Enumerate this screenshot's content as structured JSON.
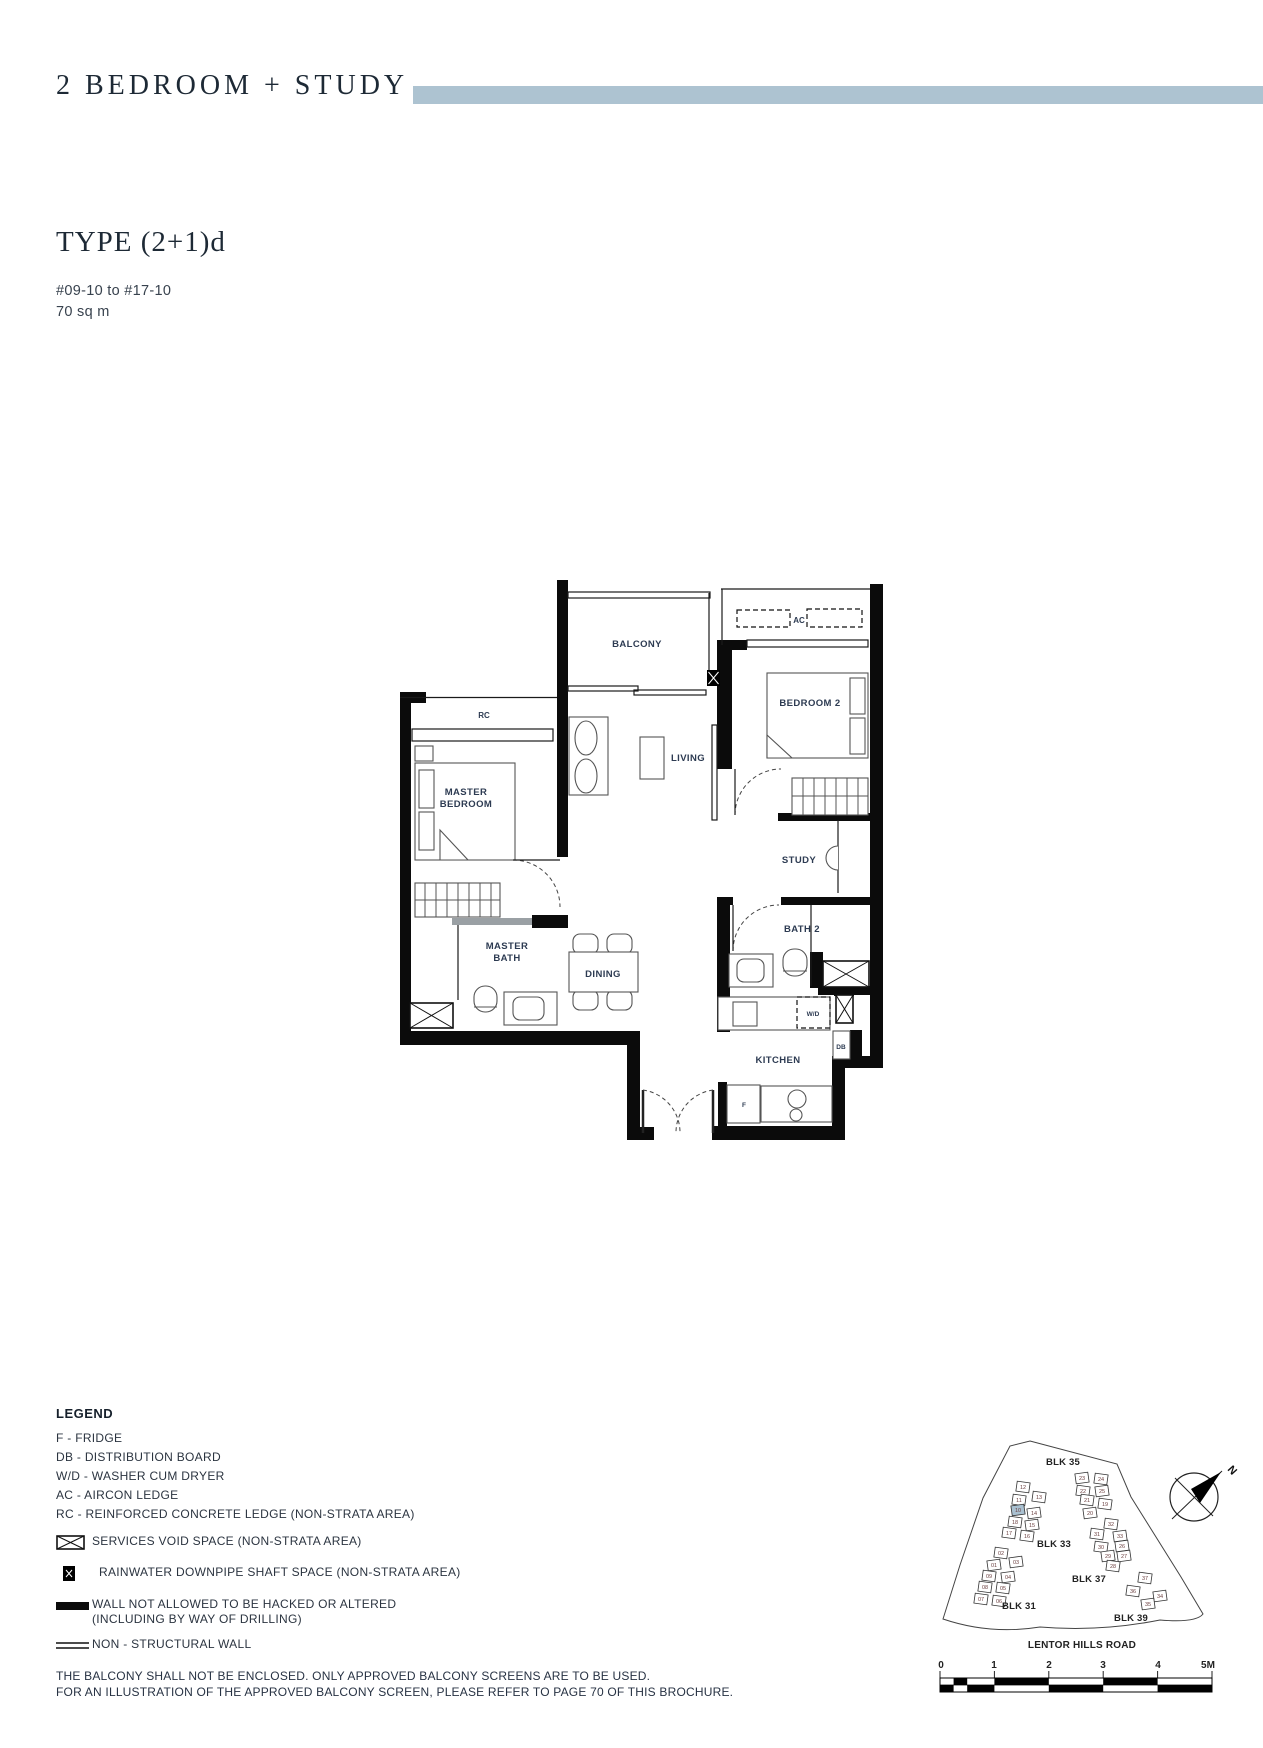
{
  "page": {
    "title": "2 BEDROOM + STUDY",
    "type_title": "TYPE (2+1)d",
    "units_range": "#09-10 to #17-10",
    "area": "70 sq m",
    "accent_color": "#adc3d1"
  },
  "plan": {
    "labels": {
      "balcony": "BALCONY",
      "rc": "RC",
      "ac": "AC",
      "master_bedroom_1": "MASTER",
      "master_bedroom_2": "BEDROOM",
      "living": "LIVING",
      "bedroom2": "BEDROOM 2",
      "study": "STUDY",
      "master_bath_1": "MASTER",
      "master_bath_2": "BATH",
      "dining": "DINING",
      "bath2": "BATH 2",
      "kitchen": "KITCHEN",
      "wd": "W/D",
      "db": "DB",
      "f": "F"
    }
  },
  "legend": {
    "heading": "LEGEND",
    "abbreviations": [
      "F - FRIDGE",
      "DB - DISTRIBUTION BOARD",
      "W/D - WASHER CUM DRYER",
      "AC - AIRCON LEDGE",
      "RC - REINFORCED CONCRETE LEDGE (NON-STRATA AREA)"
    ],
    "symbols": [
      {
        "icon": "services-void-icon",
        "label": "SERVICES VOID SPACE (NON-STRATA AREA)"
      },
      {
        "icon": "rainwater-shaft-icon",
        "label": "RAINWATER DOWNPIPE SHAFT SPACE (NON-STRATA AREA)"
      },
      {
        "icon": "no-hack-wall-icon",
        "label": "WALL NOT ALLOWED TO BE HACKED OR ALTERED",
        "label2": "(INCLUDING BY WAY OF DRILLING)"
      },
      {
        "icon": "non-structural-wall-icon",
        "label": "NON - STRUCTURAL WALL"
      }
    ]
  },
  "site_plan": {
    "blocks": [
      "BLK 35",
      "BLK 33",
      "BLK 31",
      "BLK 37",
      "BLK 39"
    ],
    "road": "LENTOR HILLS ROAD",
    "compass_label": "N",
    "highlight_unit": "10",
    "highlight_color": "#a9c0d0",
    "units": [
      [
        "12",
        1023,
        1487,
        0
      ],
      [
        "11",
        1019,
        1500,
        0
      ],
      [
        "13",
        1039,
        1497,
        0
      ],
      [
        "10",
        1018,
        1510,
        1
      ],
      [
        "14",
        1034,
        1513,
        0
      ],
      [
        "18",
        1015,
        1522,
        0
      ],
      [
        "15",
        1032,
        1525,
        0
      ],
      [
        "17",
        1009,
        1533,
        0
      ],
      [
        "16",
        1027,
        1536,
        0
      ],
      [
        "02",
        1001,
        1553,
        0
      ],
      [
        "01",
        994,
        1565,
        0
      ],
      [
        "03",
        1016,
        1562,
        0
      ],
      [
        "09",
        989,
        1576,
        0
      ],
      [
        "04",
        1008,
        1577,
        0
      ],
      [
        "08",
        985,
        1587,
        0
      ],
      [
        "05",
        1003,
        1588,
        0
      ],
      [
        "07",
        981,
        1599,
        0
      ],
      [
        "06",
        999,
        1601,
        0
      ],
      [
        "23",
        1082,
        1478,
        0
      ],
      [
        "24",
        1101,
        1479,
        0
      ],
      [
        "22",
        1083,
        1491,
        0
      ],
      [
        "25",
        1102,
        1491,
        0
      ],
      [
        "21",
        1087,
        1500,
        0
      ],
      [
        "19",
        1105,
        1504,
        0
      ],
      [
        "20",
        1090,
        1513,
        0
      ],
      [
        "32",
        1111,
        1524,
        0
      ],
      [
        "31",
        1097,
        1534,
        0
      ],
      [
        "33",
        1120,
        1536,
        0
      ],
      [
        "30",
        1101,
        1547,
        0
      ],
      [
        "26",
        1122,
        1546,
        0
      ],
      [
        "29",
        1108,
        1556,
        0
      ],
      [
        "27",
        1124,
        1556,
        0
      ],
      [
        "28",
        1113,
        1566,
        0
      ],
      [
        "37",
        1145,
        1578,
        0
      ],
      [
        "36",
        1133,
        1591,
        0
      ],
      [
        "34",
        1160,
        1596,
        0
      ],
      [
        "35",
        1148,
        1604,
        0
      ]
    ]
  },
  "scalebar": {
    "labels": [
      "0",
      "1",
      "2",
      "3",
      "4",
      "5M"
    ]
  },
  "footer": {
    "line1": "THE BALCONY SHALL NOT BE ENCLOSED. ONLY APPROVED BALCONY SCREENS ARE TO BE USED.",
    "line2": "FOR AN ILLUSTRATION OF THE APPROVED BALCONY SCREEN, PLEASE REFER TO PAGE 70 OF THIS BROCHURE."
  }
}
